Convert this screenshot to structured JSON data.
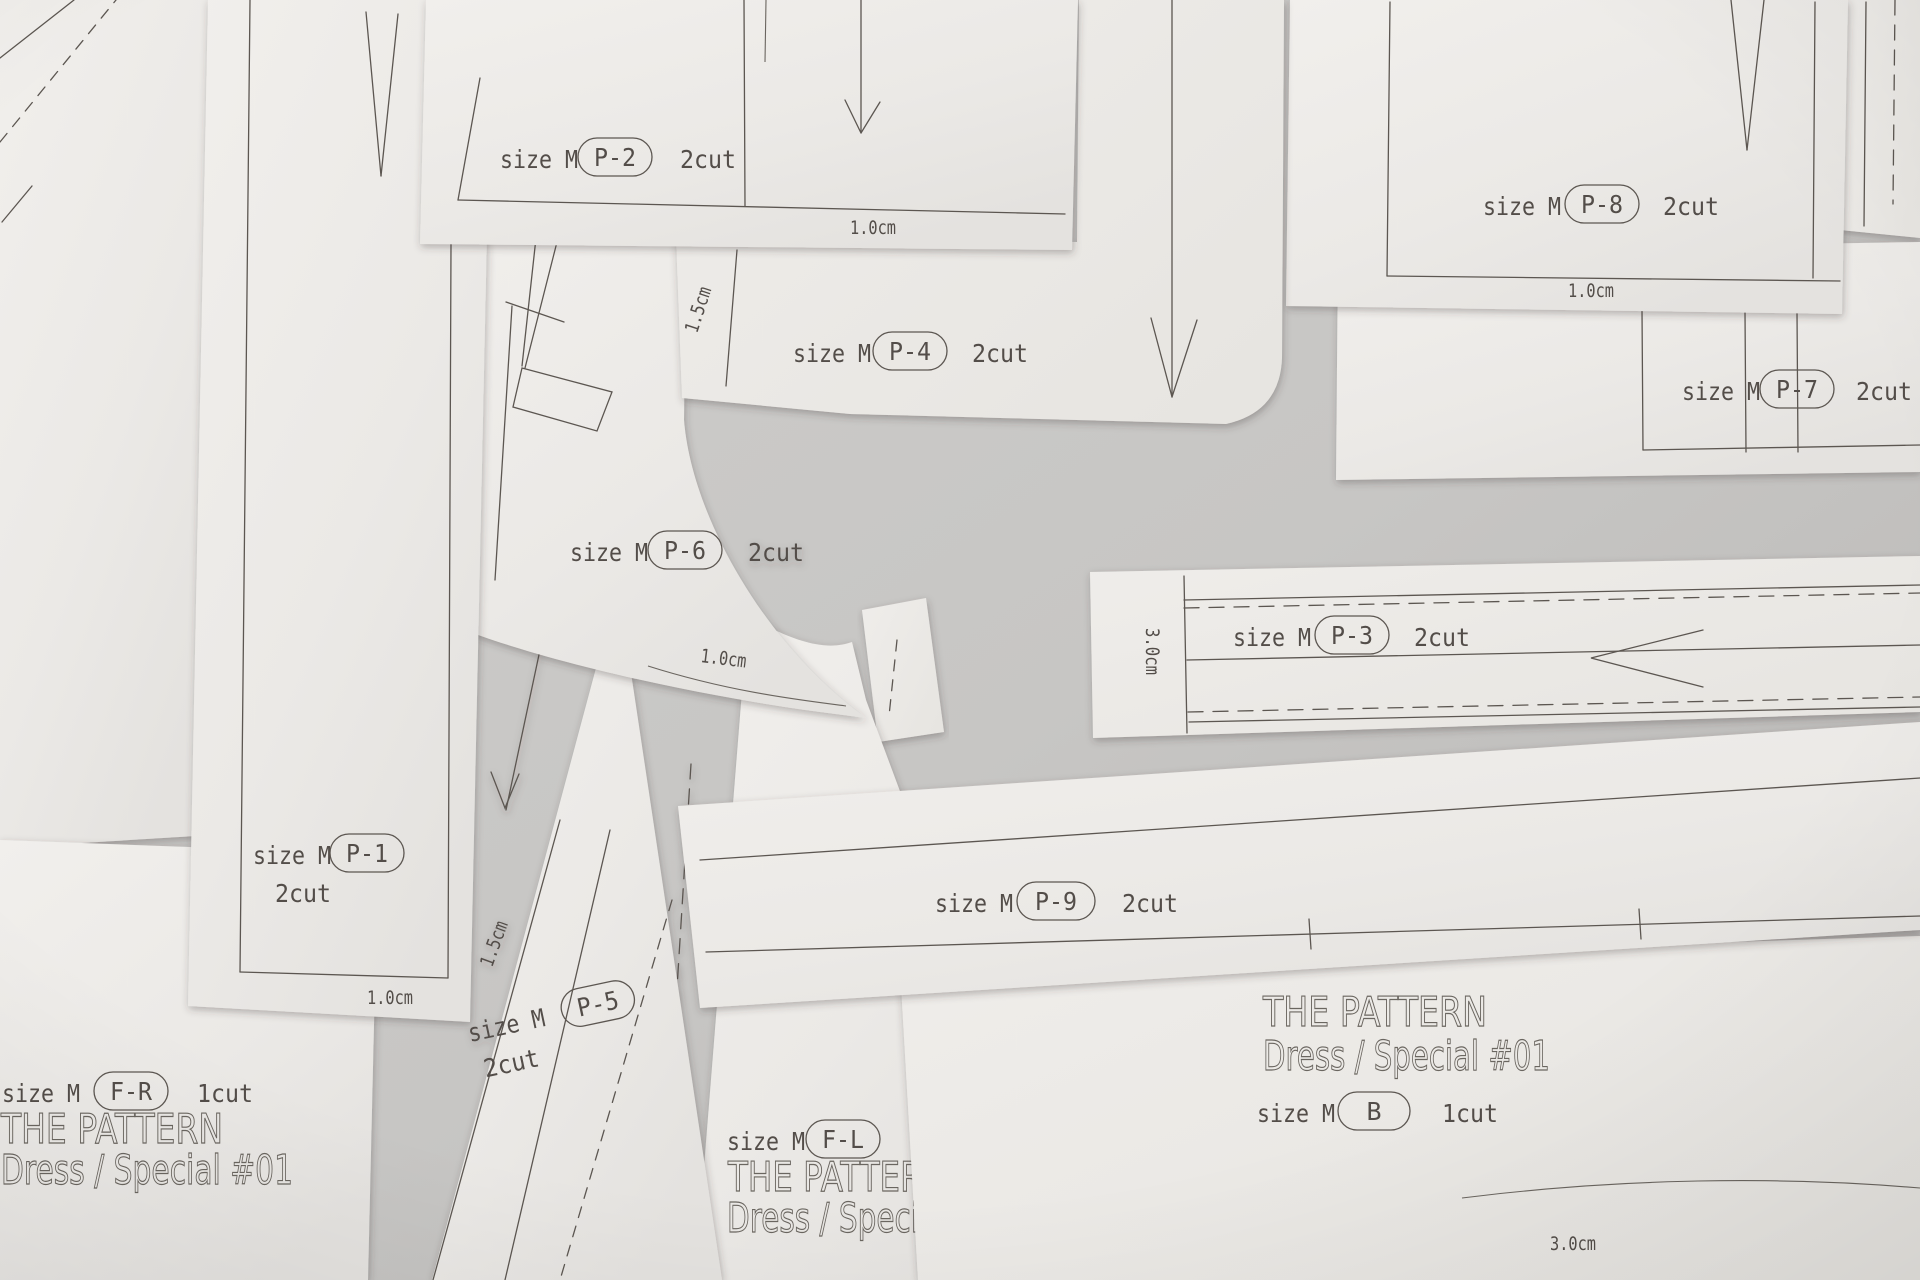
{
  "labels": {
    "size": "size M",
    "cut2": "2cut",
    "cut1": "1cut",
    "title": "THE PATTERN",
    "subtitle": "Dress / Special #01"
  },
  "codes": {
    "p1": "P-1",
    "p2": "P-2",
    "p3": "P-3",
    "p4": "P-4",
    "p5": "P-5",
    "p6": "P-6",
    "p7": "P-7",
    "p8": "P-8",
    "p9": "P-9",
    "fr": "F-R",
    "fl": "F-L",
    "b": "B"
  },
  "measurements": {
    "p2_bottom": "1.0cm",
    "p4_left": "1.5cm",
    "p8_bottom": "1.0cm",
    "p1_bottom": "1.0cm",
    "p6_curve": "1.0cm",
    "p5_left": "1.5cm",
    "p3_left": "3.0cm",
    "b_bottom": "3.0cm"
  }
}
